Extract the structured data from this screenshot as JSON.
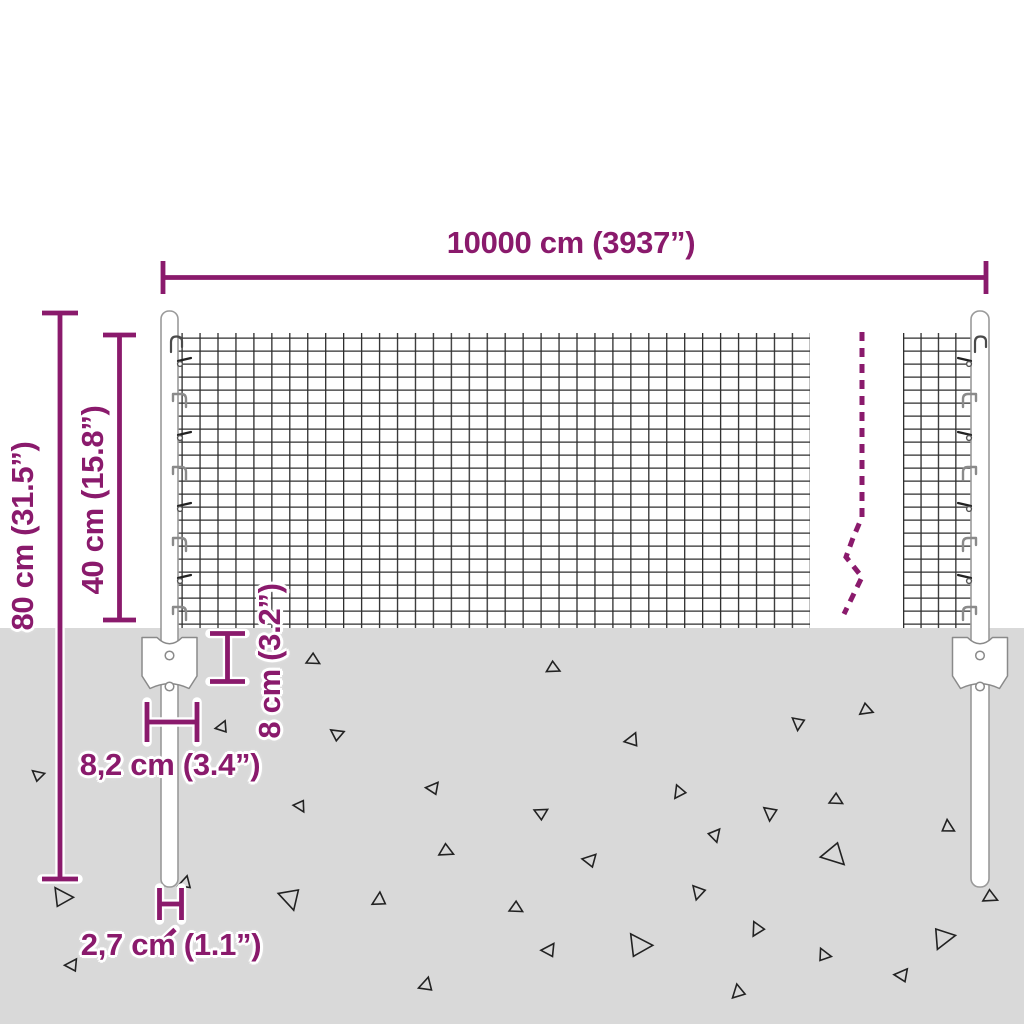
{
  "diagram": {
    "subject": "wire-mesh-fence-with-posts-dimension-diagram",
    "labels": {
      "total_length": "10000 cm (3937”)",
      "mesh_height": "40 cm (15.8”)",
      "overall_post_height": "80 cm (31.5”)",
      "anchor_plate_depth": "8 cm (3.2”)",
      "anchor_plate_width": "8,2 cm (3.4”)",
      "post_diameter": "2,7 cm (1.1”)"
    },
    "colors": {
      "dimension_accent": "#8a1a6c",
      "ground": "#d9d9d9",
      "wire": "#2e2e2e",
      "post_outline": "#9a9a9a",
      "background": "#ffffff"
    },
    "ground_texture": {
      "mark": "triangle-outline",
      "marks": [
        [
          313,
          660,
          13,
          10
        ],
        [
          38,
          775,
          12,
          200
        ],
        [
          222,
          727,
          12,
          150
        ],
        [
          337,
          734,
          13,
          195
        ],
        [
          300,
          806,
          12,
          40
        ],
        [
          433,
          788,
          13,
          165
        ],
        [
          446,
          851,
          14,
          5
        ],
        [
          62,
          897,
          20,
          215
        ],
        [
          185,
          883,
          13,
          140
        ],
        [
          290,
          898,
          22,
          55
        ],
        [
          379,
          900,
          14,
          130
        ],
        [
          72,
          965,
          13,
          160
        ],
        [
          426,
          985,
          14,
          140
        ],
        [
          553,
          668,
          13,
          5
        ],
        [
          632,
          740,
          14,
          150
        ],
        [
          798,
          723,
          13,
          75
        ],
        [
          866,
          710,
          13,
          0
        ],
        [
          679,
          792,
          13,
          105
        ],
        [
          836,
          800,
          13,
          10
        ],
        [
          770,
          813,
          14,
          75
        ],
        [
          541,
          813,
          13,
          185
        ],
        [
          715,
          835,
          13,
          290
        ],
        [
          834,
          855,
          24,
          25
        ],
        [
          948,
          827,
          13,
          245
        ],
        [
          590,
          860,
          14,
          170
        ],
        [
          698,
          892,
          14,
          85
        ],
        [
          516,
          908,
          13,
          10
        ],
        [
          757,
          929,
          14,
          100
        ],
        [
          639,
          945,
          24,
          215
        ],
        [
          549,
          950,
          14,
          160
        ],
        [
          824,
          955,
          13,
          225
        ],
        [
          943,
          938,
          22,
          330
        ],
        [
          902,
          975,
          14,
          165
        ],
        [
          738,
          992,
          14,
          115
        ],
        [
          990,
          897,
          14,
          5
        ]
      ]
    },
    "structure": {
      "left_post": "round steel post",
      "right_post": "round steel post",
      "break_line": "dashed zigzag continuation mark",
      "anchor": "ground anchor plate with two holes"
    }
  }
}
